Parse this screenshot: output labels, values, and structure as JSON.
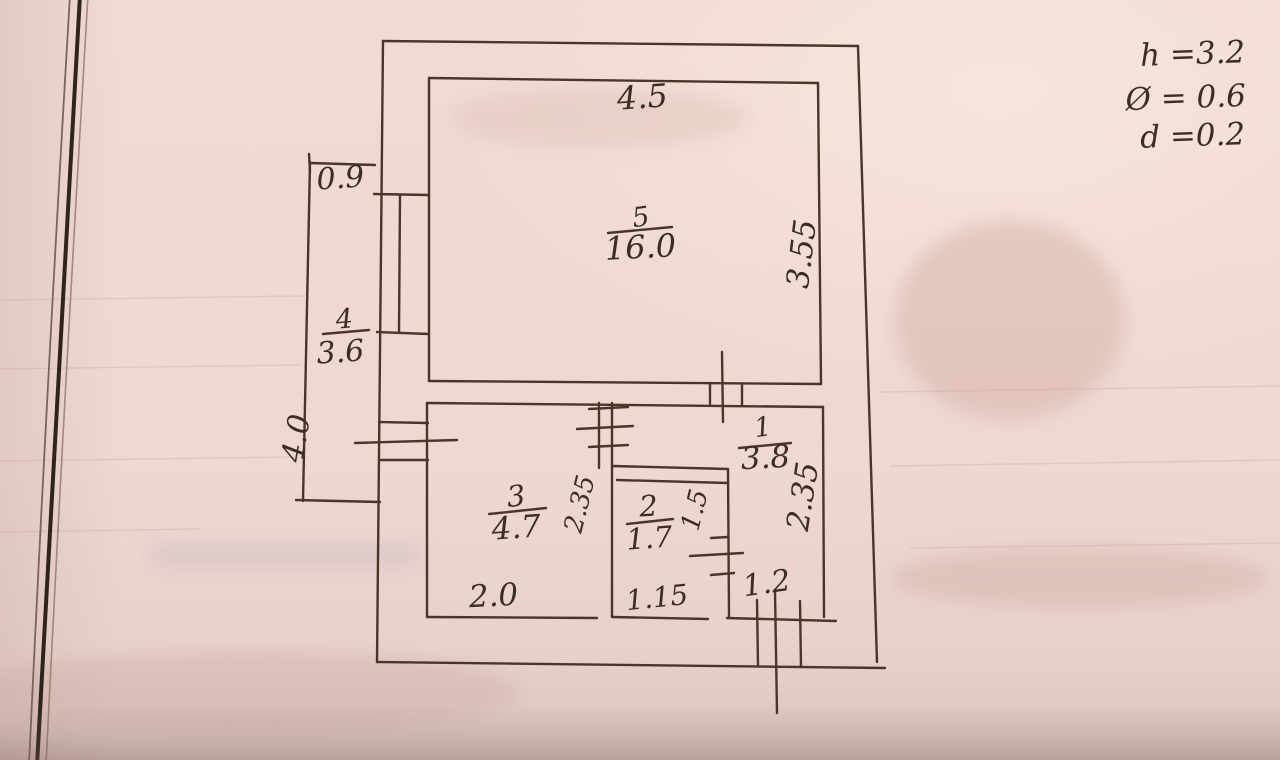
{
  "plan": {
    "rooms": [
      {
        "number": "5",
        "area": "16.0"
      },
      {
        "number": "4",
        "area": "3.6"
      },
      {
        "number": "3",
        "area": "4.7"
      },
      {
        "number": "2",
        "area": "1.7"
      },
      {
        "number": "1",
        "area": "3.8"
      }
    ],
    "dimensions": {
      "room5_width": "4.5",
      "room5_height": "3.55",
      "balcony_width": "0.9",
      "balcony_height": "4.0",
      "room3_width": "2.0",
      "room3_height": "2.35",
      "room2_width": "1.15",
      "room2_height": "1.5",
      "hall_height": "2.35",
      "entrance_width": "1.2"
    },
    "notes": [
      {
        "text": "h =3.2"
      },
      {
        "text": "Ø = 0.6"
      },
      {
        "text": "d =0.2"
      }
    ],
    "ink_color": "#4a3629",
    "paper_color": "#efd8d2"
  }
}
